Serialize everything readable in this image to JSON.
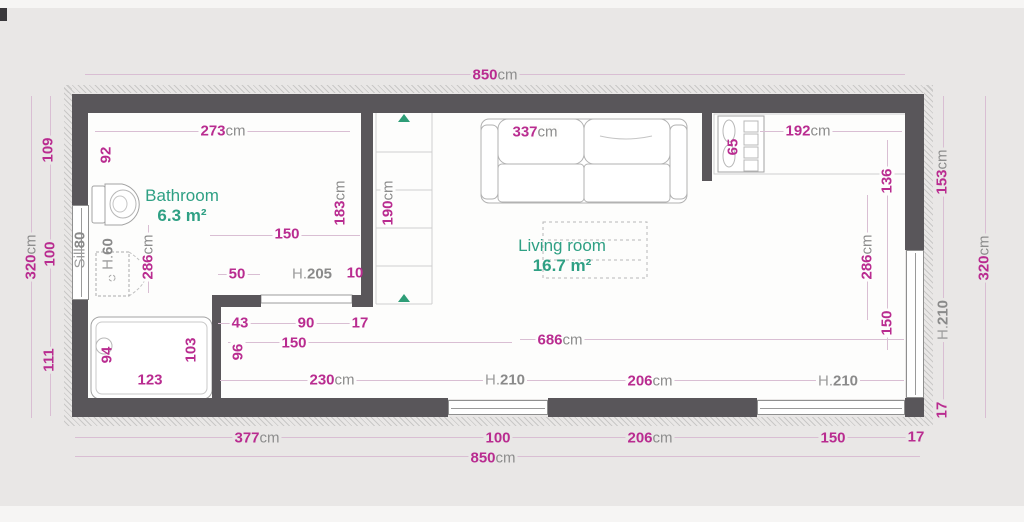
{
  "rooms": [
    {
      "name": "Bathroom",
      "area": "6.3 m²"
    },
    {
      "name": "Living room",
      "area": "16.7 m²"
    }
  ],
  "unit_suffix": "cm",
  "colors": {
    "dimension_text": "#b92c90",
    "unit_suffix_text": "#8d8d8d",
    "reference_text": "#9c9c9c",
    "room_text": "#2fa084",
    "wall": "#59565a",
    "floor": "#fdfdfc",
    "background": "#e9e7e6",
    "direction_triangle": "#2e9d77"
  },
  "dimension_labels": [
    {
      "t": "850",
      "s": "cm",
      "x": 495,
      "y": 75,
      "r": 0,
      "k": "dim",
      "bg": "out"
    },
    {
      "t": "273",
      "s": "cm",
      "x": 223,
      "y": 131,
      "r": 0,
      "k": "dim",
      "bg": "in"
    },
    {
      "t": "337",
      "s": "cm",
      "x": 535,
      "y": 132,
      "r": 0,
      "k": "dim",
      "bg": "in"
    },
    {
      "t": "192",
      "s": "cm",
      "x": 808,
      "y": 131,
      "r": 0,
      "k": "dim",
      "bg": "in"
    },
    {
      "t": "109",
      "s": "",
      "x": 48,
      "y": 150,
      "r": -90,
      "k": "dim",
      "bg": "out"
    },
    {
      "t": "92",
      "s": "",
      "x": 106,
      "y": 155,
      "r": -90,
      "k": "dim",
      "bg": "in"
    },
    {
      "t": "65",
      "s": "",
      "x": 733,
      "y": 147,
      "r": -90,
      "k": "dim",
      "bg": "none"
    },
    {
      "t": "136",
      "s": "",
      "x": 887,
      "y": 181,
      "r": -90,
      "k": "dim",
      "bg": "in"
    },
    {
      "t": "153",
      "s": "cm",
      "x": 942,
      "y": 172,
      "r": -90,
      "k": "dim",
      "bg": "out"
    },
    {
      "t": "320",
      "s": "cm",
      "x": 31,
      "y": 257,
      "r": -90,
      "k": "dim",
      "bg": "out"
    },
    {
      "t": "100",
      "s": "",
      "x": 50,
      "y": 254,
      "r": -90,
      "k": "dim",
      "bg": "out"
    },
    {
      "t": "111",
      "s": "",
      "x": 49,
      "y": 360,
      "r": -90,
      "k": "dim",
      "bg": "out"
    },
    {
      "t": "320",
      "s": "cm",
      "x": 984,
      "y": 258,
      "r": -90,
      "k": "dim",
      "bg": "out"
    },
    {
      "t": "Sill",
      "s": "80",
      "x": 80,
      "y": 250,
      "r": -90,
      "k": "ref",
      "bg": "none"
    },
    {
      "t": "H.",
      "s": "60",
      "x": 108,
      "y": 254,
      "r": -90,
      "k": "ref",
      "bg": "none"
    },
    {
      "t": "286",
      "s": "cm",
      "x": 148,
      "y": 257,
      "r": -90,
      "k": "dim",
      "bg": "in"
    },
    {
      "t": "183",
      "s": "cm",
      "x": 340,
      "y": 203,
      "r": -90,
      "k": "dim",
      "bg": "in"
    },
    {
      "t": "190",
      "s": "cm",
      "x": 388,
      "y": 203,
      "r": -90,
      "k": "dim",
      "bg": "in"
    },
    {
      "t": "150",
      "s": "",
      "x": 287,
      "y": 234,
      "r": 0,
      "k": "dim",
      "bg": "in"
    },
    {
      "t": "50",
      "s": "",
      "x": 237,
      "y": 274,
      "r": 0,
      "k": "dim",
      "bg": "in"
    },
    {
      "t": "H.",
      "s": "205",
      "x": 312,
      "y": 274,
      "r": 0,
      "k": "ref",
      "bg": "in"
    },
    {
      "t": "10",
      "s": "",
      "x": 355,
      "y": 273,
      "r": 0,
      "k": "dim",
      "bg": "none"
    },
    {
      "t": "286",
      "s": "cm",
      "x": 867,
      "y": 257,
      "r": -90,
      "k": "dim",
      "bg": "in"
    },
    {
      "t": "150",
      "s": "",
      "x": 887,
      "y": 323,
      "r": -90,
      "k": "dim",
      "bg": "in"
    },
    {
      "t": "H.",
      "s": "210",
      "x": 943,
      "y": 320,
      "r": -90,
      "k": "ref",
      "bg": "out"
    },
    {
      "t": "17",
      "s": "",
      "x": 942,
      "y": 410,
      "r": -90,
      "k": "dim",
      "bg": "out"
    },
    {
      "t": "43",
      "s": "",
      "x": 240,
      "y": 323,
      "r": 0,
      "k": "dim",
      "bg": "in"
    },
    {
      "t": "90",
      "s": "",
      "x": 306,
      "y": 323,
      "r": 0,
      "k": "dim",
      "bg": "in"
    },
    {
      "t": "17",
      "s": "",
      "x": 360,
      "y": 323,
      "r": 0,
      "k": "dim",
      "bg": "in"
    },
    {
      "t": "150",
      "s": "",
      "x": 294,
      "y": 343,
      "r": 0,
      "k": "dim",
      "bg": "in"
    },
    {
      "t": "96",
      "s": "",
      "x": 238,
      "y": 352,
      "r": -90,
      "k": "dim",
      "bg": "in"
    },
    {
      "t": "686",
      "s": "cm",
      "x": 560,
      "y": 340,
      "r": 0,
      "k": "dim",
      "bg": "in"
    },
    {
      "t": "94",
      "s": "",
      "x": 107,
      "y": 355,
      "r": -90,
      "k": "dim",
      "bg": "none"
    },
    {
      "t": "103",
      "s": "",
      "x": 191,
      "y": 350,
      "r": -90,
      "k": "dim",
      "bg": "none"
    },
    {
      "t": "123",
      "s": "",
      "x": 150,
      "y": 380,
      "r": 0,
      "k": "dim",
      "bg": "none"
    },
    {
      "t": "230",
      "s": "cm",
      "x": 332,
      "y": 380,
      "r": 0,
      "k": "dim",
      "bg": "in"
    },
    {
      "t": "H.",
      "s": "210",
      "x": 505,
      "y": 380,
      "r": 0,
      "k": "ref",
      "bg": "in"
    },
    {
      "t": "206",
      "s": "cm",
      "x": 650,
      "y": 381,
      "r": 0,
      "k": "dim",
      "bg": "in"
    },
    {
      "t": "H.",
      "s": "210",
      "x": 838,
      "y": 381,
      "r": 0,
      "k": "ref",
      "bg": "in"
    },
    {
      "t": "377",
      "s": "cm",
      "x": 257,
      "y": 438,
      "r": 0,
      "k": "dim",
      "bg": "out"
    },
    {
      "t": "100",
      "s": "",
      "x": 498,
      "y": 438,
      "r": 0,
      "k": "dim",
      "bg": "out"
    },
    {
      "t": "206",
      "s": "cm",
      "x": 650,
      "y": 438,
      "r": 0,
      "k": "dim",
      "bg": "out"
    },
    {
      "t": "150",
      "s": "",
      "x": 833,
      "y": 438,
      "r": 0,
      "k": "dim",
      "bg": "out"
    },
    {
      "t": "17",
      "s": "",
      "x": 916,
      "y": 437,
      "r": 0,
      "k": "dim",
      "bg": "out"
    },
    {
      "t": "850",
      "s": "cm",
      "x": 493,
      "y": 458,
      "r": 0,
      "k": "dim",
      "bg": "out"
    }
  ],
  "dimension_lines": [
    {
      "x": 85,
      "y": 74,
      "w": 820,
      "h": 1
    },
    {
      "x": 95,
      "y": 131,
      "w": 255,
      "h": 1
    },
    {
      "x": 760,
      "y": 131,
      "w": 142,
      "h": 1
    },
    {
      "x": 31,
      "y": 96,
      "w": 1,
      "h": 322
    },
    {
      "x": 50,
      "y": 96,
      "w": 1,
      "h": 320
    },
    {
      "x": 943,
      "y": 96,
      "w": 1,
      "h": 320
    },
    {
      "x": 985,
      "y": 96,
      "w": 1,
      "h": 322
    },
    {
      "x": 210,
      "y": 235,
      "w": 150,
      "h": 1
    },
    {
      "x": 218,
      "y": 274,
      "w": 42,
      "h": 1
    },
    {
      "x": 218,
      "y": 323,
      "w": 148,
      "h": 1
    },
    {
      "x": 228,
      "y": 342,
      "w": 284,
      "h": 1
    },
    {
      "x": 520,
      "y": 339,
      "w": 384,
      "h": 1
    },
    {
      "x": 220,
      "y": 380,
      "w": 684,
      "h": 1
    },
    {
      "x": 75,
      "y": 437,
      "w": 848,
      "h": 1
    },
    {
      "x": 75,
      "y": 456,
      "w": 845,
      "h": 1
    },
    {
      "x": 148,
      "y": 225,
      "w": 1,
      "h": 68
    },
    {
      "x": 867,
      "y": 195,
      "w": 1,
      "h": 125
    },
    {
      "x": 887,
      "y": 140,
      "w": 1,
      "h": 210
    }
  ]
}
